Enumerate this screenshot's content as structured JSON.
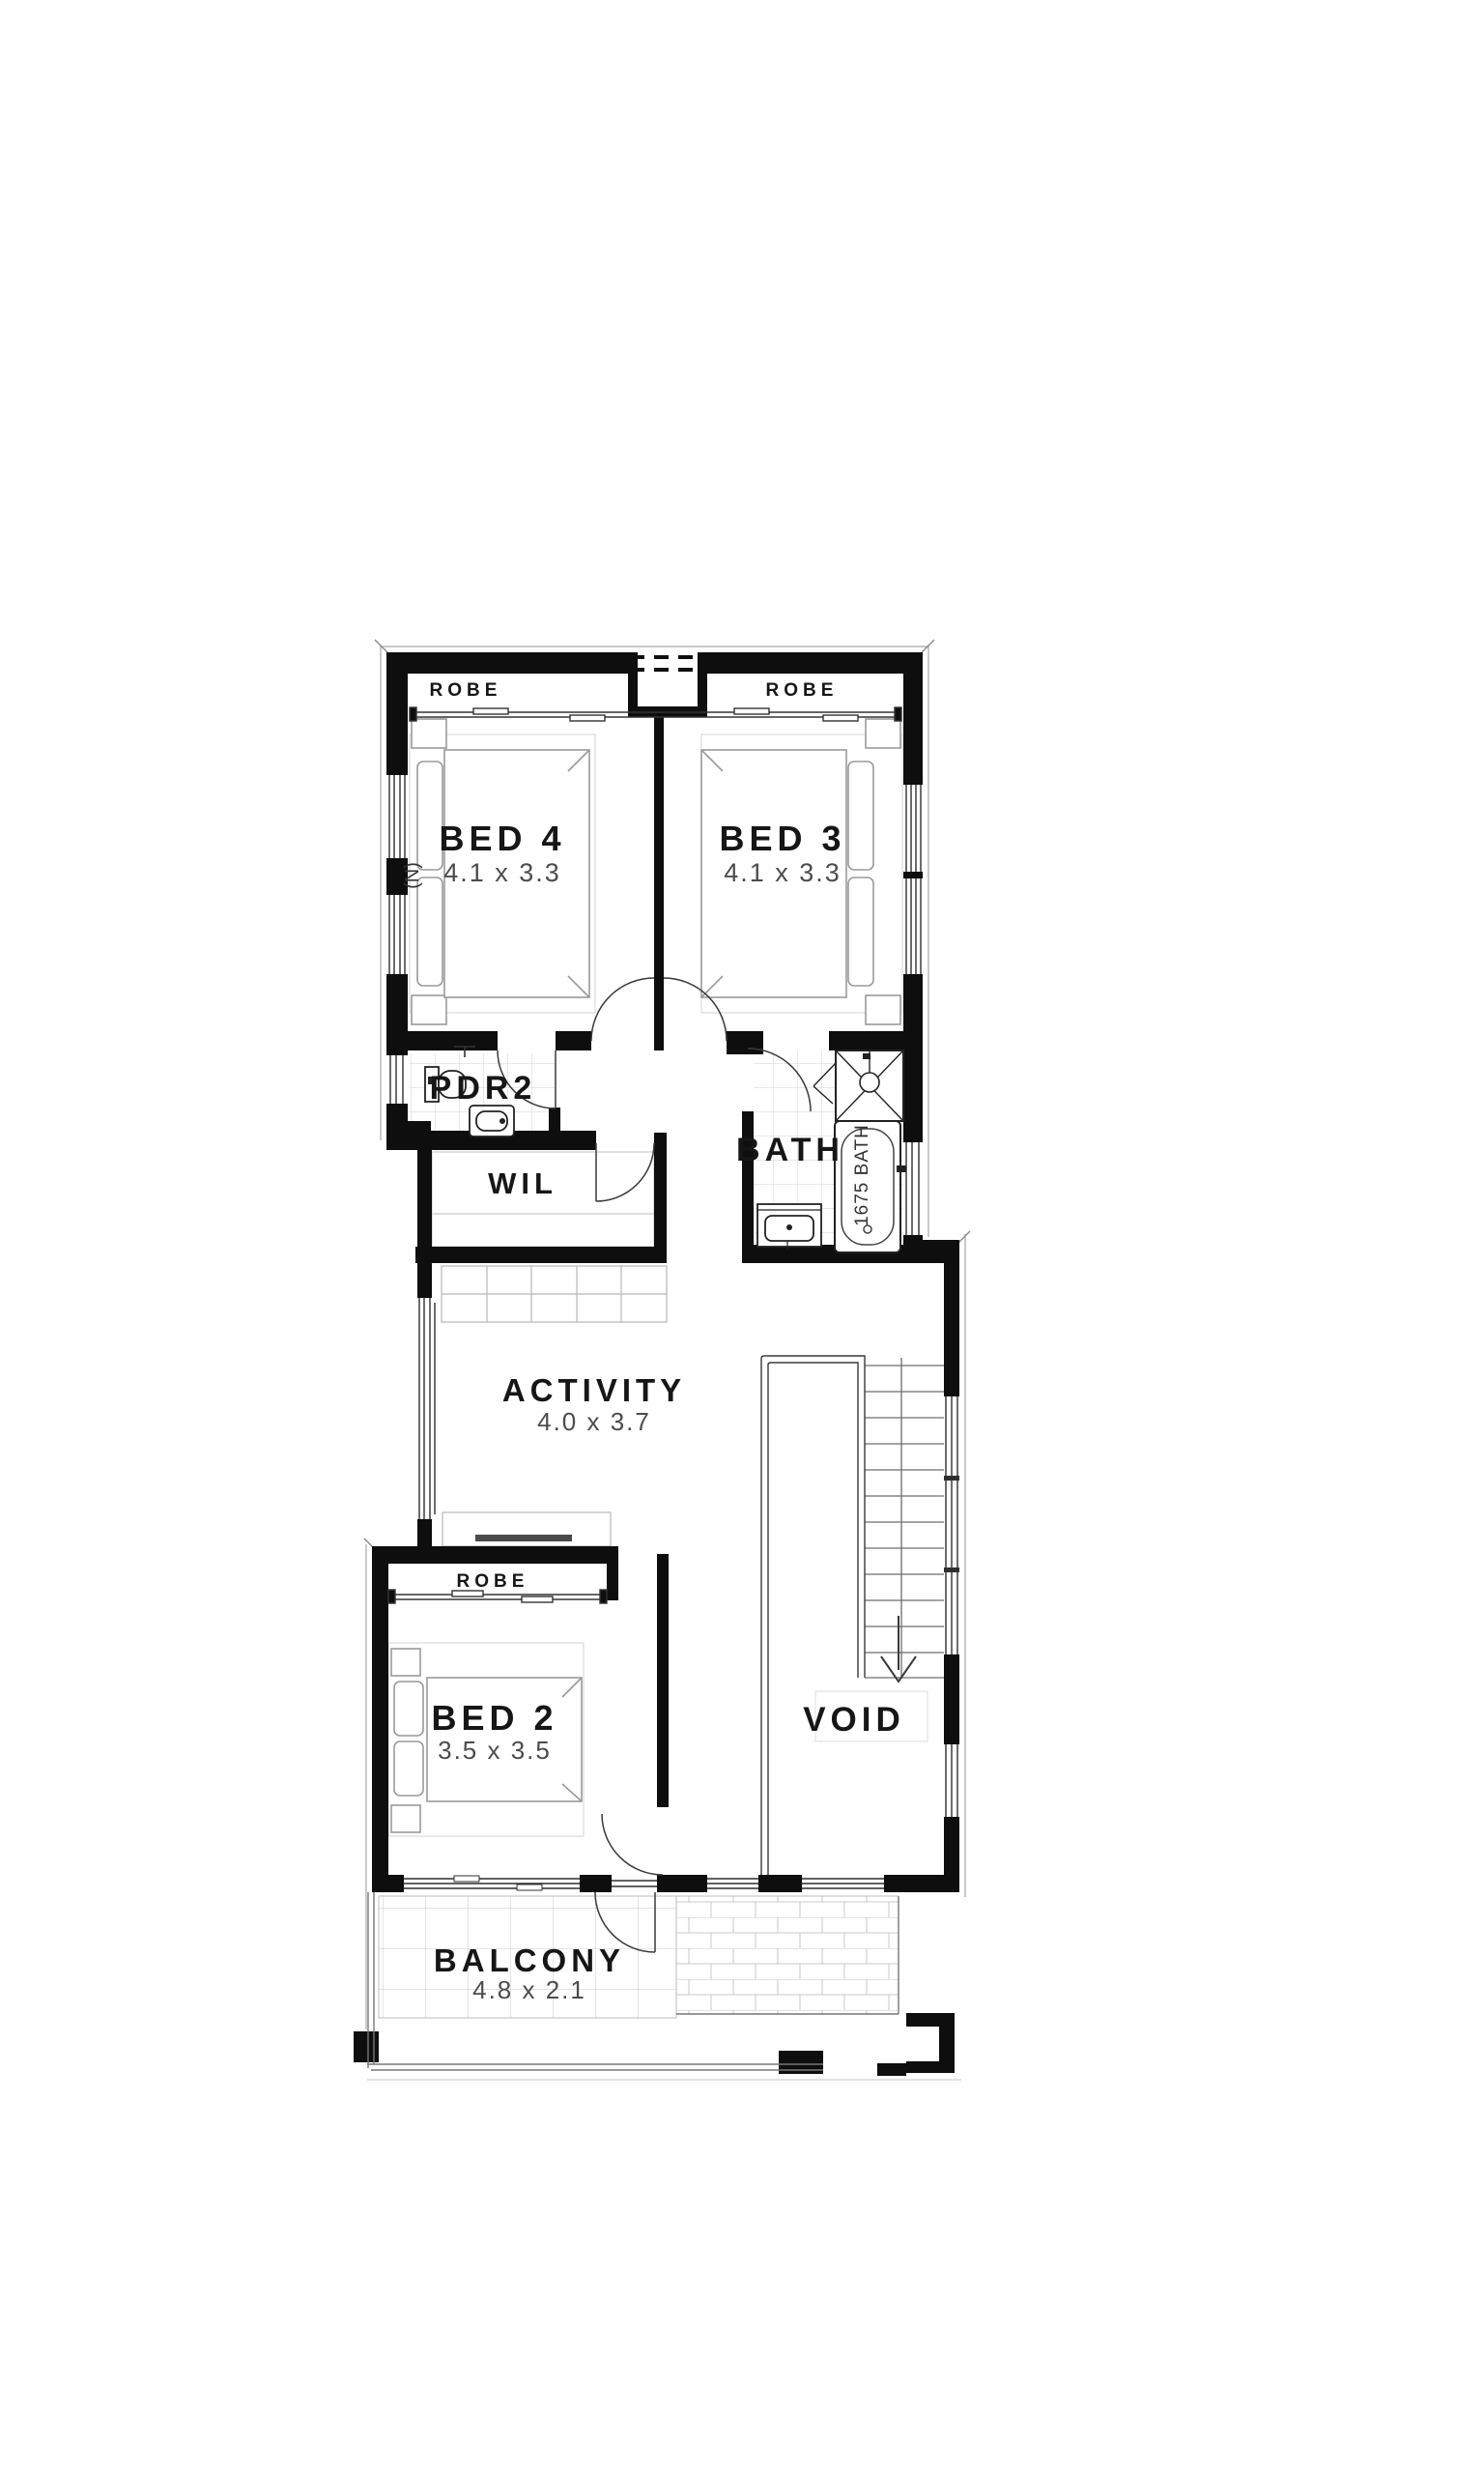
{
  "plan": {
    "rooms": [
      {
        "id": "bed4",
        "label": "BED 4",
        "dims": "4.1 x 3.3"
      },
      {
        "id": "bed3",
        "label": "BED 3",
        "dims": "4.1 x 3.3"
      },
      {
        "id": "pdr2",
        "label": "PDR2",
        "dims": ""
      },
      {
        "id": "wil",
        "label": "WIL",
        "dims": ""
      },
      {
        "id": "bath",
        "label": "BATH",
        "dims": ""
      },
      {
        "id": "activity",
        "label": "ACTIVITY",
        "dims": "4.0 x 3.7"
      },
      {
        "id": "bed2",
        "label": "BED 2",
        "dims": "3.5 x 3.5"
      },
      {
        "id": "void",
        "label": "VOID",
        "dims": ""
      },
      {
        "id": "balcony",
        "label": "BALCONY",
        "dims": "4.8 x 2.1"
      }
    ],
    "wardrobes": [
      {
        "id": "robe-bed4",
        "label": "ROBE"
      },
      {
        "id": "robe-bed3",
        "label": "ROBE"
      },
      {
        "id": "robe-bed2",
        "label": "ROBE"
      }
    ],
    "annotations": {
      "north_marker": "(N)",
      "bathtub": "1675 BATH"
    },
    "colors": {
      "wall": "#0e0e0e",
      "fixture_line": "#2f2f2f",
      "furniture_line": "#9a9a9a",
      "tile_line": "#cfcfcf",
      "dim_text": "#4c4c4c",
      "label_text": "#161616"
    }
  }
}
